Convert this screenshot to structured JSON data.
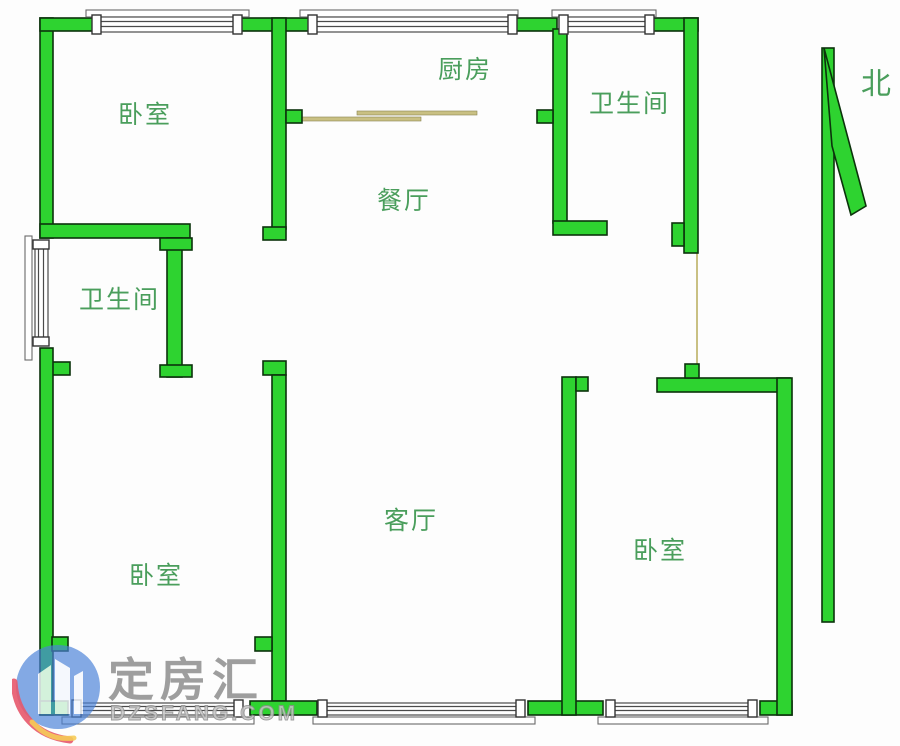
{
  "colors": {
    "background": "#fdfdfd",
    "wall": "#2ed330",
    "wall_outline": "#0c330c",
    "label": "#4a9e5c",
    "door_line": "#c9c083",
    "window_frame": "#4a4a4a",
    "sill": "#6a6a6a",
    "watermark_text": "#8e8e8e",
    "logo_blue": "#4a82d8",
    "logo_red": "#e23b52",
    "logo_yellow": "#f5c33b"
  },
  "rooms": {
    "bedroom_top_left": {
      "label": "卧室"
    },
    "kitchen": {
      "label": "厨房"
    },
    "bathroom_top_right": {
      "label": "卫生间"
    },
    "dining_room": {
      "label": "餐厅"
    },
    "bathroom_left": {
      "label": "卫生间"
    },
    "living_room": {
      "label": "客厅"
    },
    "bedroom_bottom_left": {
      "label": "卧室"
    },
    "bedroom_bottom_right": {
      "label": "卧室"
    }
  },
  "compass": {
    "label": "北"
  },
  "watermark": {
    "brand": "定房汇",
    "domain": "DZSFANG.COM"
  }
}
